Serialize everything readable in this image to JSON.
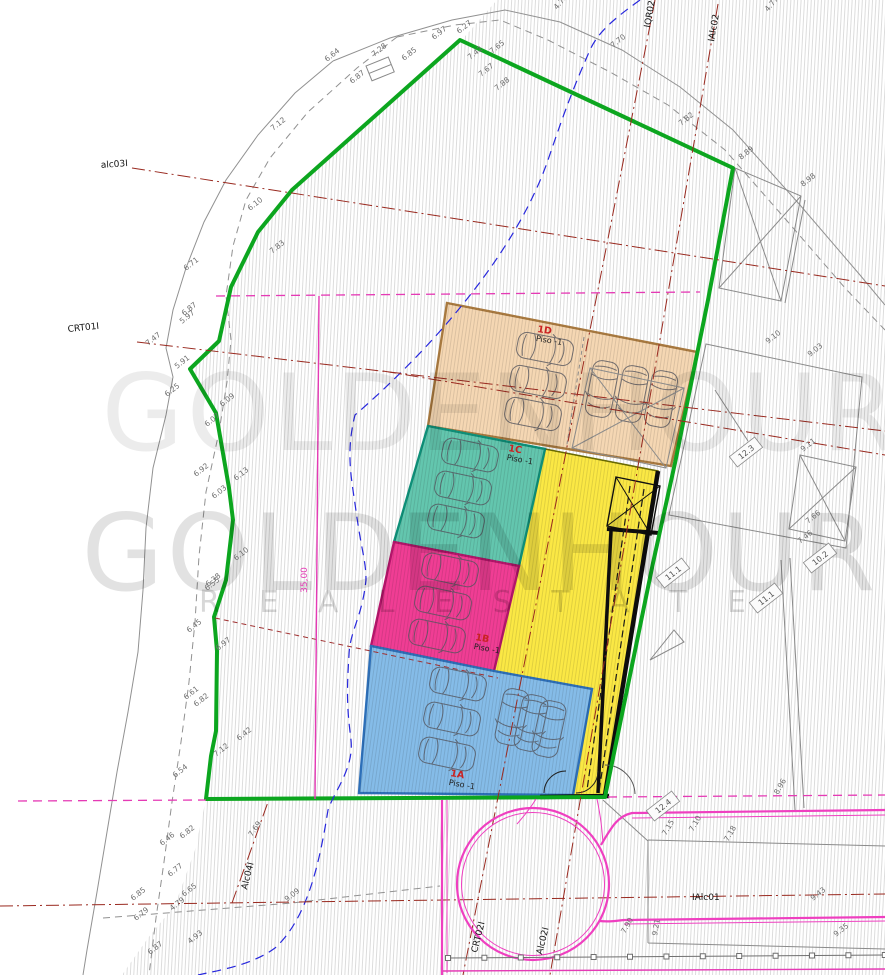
{
  "watermark": {
    "brand": "GOLDENHOUR",
    "tagline": "R E A L  E S T A T E"
  },
  "zones": [
    {
      "id": "1D",
      "name": "Piso -1",
      "fill": "#f5d7b3",
      "edge": "#a8793f"
    },
    {
      "id": "1C",
      "name": "Piso -1",
      "fill": "#63c6ae",
      "edge": "#0e8f78"
    },
    {
      "id": "1B",
      "name": "Piso -1",
      "fill": "#f03d94",
      "edge": "#b5156b"
    },
    {
      "id": "1A",
      "name": "Piso -1",
      "fill": "#85bce8",
      "edge": "#2d6fb8"
    },
    {
      "id": "ramp",
      "name": "",
      "fill": "#fbe844",
      "edge": "#111111"
    }
  ],
  "colors": {
    "site_boundary_green": "#0ca61f",
    "parcel_dash_magenta": "#e53ab5",
    "road_outline_pink": "#ef3fc0",
    "contour_blue": "#2727dd",
    "alignment_red": "#99291f",
    "contour_gray": "#919191",
    "hatch_gray": "#d9d9d9"
  },
  "dimension_line": {
    "label": "35,00"
  },
  "alignment_labels": [
    {
      "text": "alc03I",
      "x": 128,
      "y": 166,
      "rot": -4,
      "anchor": "end",
      "cls": "align"
    },
    {
      "text": "CRT01I",
      "x": 68,
      "y": 332,
      "rot": -6,
      "anchor": "start",
      "cls": "align"
    },
    {
      "text": "IQR02I",
      "x": 650,
      "y": 28,
      "rot": -80,
      "anchor": "start",
      "cls": "align"
    },
    {
      "text": "IAlc02",
      "x": 714,
      "y": 42,
      "rot": -80,
      "anchor": "start",
      "cls": "align"
    },
    {
      "text": "Alc04I",
      "x": 247,
      "y": 890,
      "rot": -76,
      "anchor": "start",
      "cls": "align"
    },
    {
      "text": "CRT02I",
      "x": 477,
      "y": 953,
      "rot": -76,
      "anchor": "start",
      "cls": "align"
    },
    {
      "text": "Alc02I",
      "x": 542,
      "y": 955,
      "rot": -76,
      "anchor": "start",
      "cls": "align"
    },
    {
      "text": "IAlc01",
      "x": 692,
      "y": 900,
      "rot": 0,
      "anchor": "start",
      "cls": "align"
    },
    {
      "text": "35,00",
      "x": 307,
      "y": 580,
      "rot": -90,
      "anchor": "middle",
      "cls": "align mag"
    }
  ],
  "dimension_tags": [
    [
      746,
      452,
      "12.3"
    ],
    [
      820,
      558,
      "10.2"
    ],
    [
      673,
      573,
      "11.1"
    ],
    [
      766,
      598,
      "11.1"
    ],
    [
      663,
      806,
      "12.4"
    ]
  ],
  "elevation_marks": [
    [
      327,
      62,
      "6.64"
    ],
    [
      374,
      57,
      "7.28"
    ],
    [
      352,
      84,
      "6.87"
    ],
    [
      404,
      61,
      "6.85"
    ],
    [
      434,
      40,
      "6.97"
    ],
    [
      459,
      34,
      "6.27"
    ],
    [
      470,
      60,
      "7.42"
    ],
    [
      492,
      54,
      "7.65"
    ],
    [
      481,
      77,
      "7.67"
    ],
    [
      497,
      91,
      "7.88"
    ],
    [
      557,
      10,
      "4.73",
      -50
    ],
    [
      613,
      48,
      "7.70"
    ],
    [
      681,
      126,
      "7.82"
    ],
    [
      768,
      12,
      "4.77",
      -50
    ],
    [
      273,
      131,
      "7.12"
    ],
    [
      250,
      211,
      "6.10"
    ],
    [
      272,
      254,
      "7.83"
    ],
    [
      186,
      271,
      "6.71"
    ],
    [
      184,
      316,
      "6.87"
    ],
    [
      148,
      346,
      "7.47"
    ],
    [
      182,
      324,
      "5.97"
    ],
    [
      177,
      369,
      "5.91"
    ],
    [
      167,
      397,
      "6.25"
    ],
    [
      207,
      427,
      "6.07"
    ],
    [
      222,
      407,
      "6.09"
    ],
    [
      196,
      477,
      "6.92"
    ],
    [
      214,
      499,
      "6.03"
    ],
    [
      236,
      481,
      "6.13"
    ],
    [
      236,
      561,
      "6.10"
    ],
    [
      208,
      587,
      "6.38"
    ],
    [
      207,
      591,
      "6.55"
    ],
    [
      189,
      633,
      "6.45"
    ],
    [
      186,
      700,
      "6.61"
    ],
    [
      196,
      707,
      "6.82"
    ],
    [
      175,
      778,
      "6.54"
    ],
    [
      218,
      651,
      "6.97"
    ],
    [
      216,
      757,
      "7.12"
    ],
    [
      239,
      741,
      "6.42"
    ],
    [
      162,
      846,
      "6.46"
    ],
    [
      182,
      839,
      "6.82"
    ],
    [
      170,
      877,
      "6.77"
    ],
    [
      133,
      901,
      "6.85"
    ],
    [
      184,
      897,
      "6.65"
    ],
    [
      136,
      921,
      "6.79"
    ],
    [
      150,
      955,
      "6.87"
    ],
    [
      287,
      902,
      "9.09"
    ],
    [
      252,
      837,
      "7.69",
      -55
    ],
    [
      172,
      911,
      "4.79"
    ],
    [
      190,
      944,
      "4.93"
    ],
    [
      803,
      187,
      "8.98"
    ],
    [
      741,
      160,
      "8.89"
    ],
    [
      768,
      344,
      "9.10"
    ],
    [
      810,
      357,
      "9.03"
    ],
    [
      803,
      452,
      "9.11"
    ],
    [
      808,
      524,
      "7.66"
    ],
    [
      800,
      544,
      "7.46"
    ],
    [
      666,
      836,
      "7.15",
      -60
    ],
    [
      693,
      832,
      "7.10",
      -60
    ],
    [
      728,
      842,
      "7.18",
      -60
    ],
    [
      625,
      934,
      "7.90",
      -60
    ],
    [
      657,
      936,
      "9.21",
      -80
    ],
    [
      813,
      901,
      "9.43"
    ],
    [
      836,
      937,
      "9.35"
    ],
    [
      778,
      795,
      "8.96",
      -60
    ]
  ]
}
